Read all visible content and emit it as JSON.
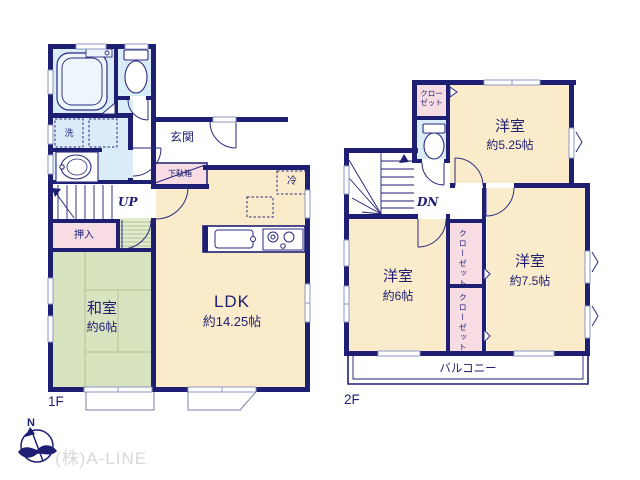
{
  "watermark": "(株)A-LINE",
  "compass": {
    "north_label": "N"
  },
  "floor1": {
    "label": "1F",
    "ldk": {
      "name": "LDK",
      "size": "約14.25帖"
    },
    "washitsu": {
      "name": "和室",
      "size": "約6帖"
    },
    "genkan": "玄関",
    "getabako": "下駄箱",
    "oshiire": "押入",
    "laundry": "洗",
    "fridge": "冷",
    "stairs_label": "UP"
  },
  "floor2": {
    "label": "2F",
    "room_525": {
      "name": "洋室",
      "size": "約5.25帖"
    },
    "room_6": {
      "name": "洋室",
      "size": "約6帖"
    },
    "room_75": {
      "name": "洋室",
      "size": "約7.5帖"
    },
    "closet_upper": {
      "line1": "クロー",
      "line2": "ゼット"
    },
    "closet_a": "クローゼット",
    "closet_b": "クローゼット",
    "balcony": "バルコニー",
    "stairs_label": "DN"
  },
  "colors": {
    "wall_navy": "#1e1e73",
    "room_cream": "#faecca",
    "tatami_green": "#d8e3bf",
    "water_blue": "#d9ecf8",
    "closet_pink": "#f8dce3",
    "watermark_gray": "#d8d8d8"
  }
}
